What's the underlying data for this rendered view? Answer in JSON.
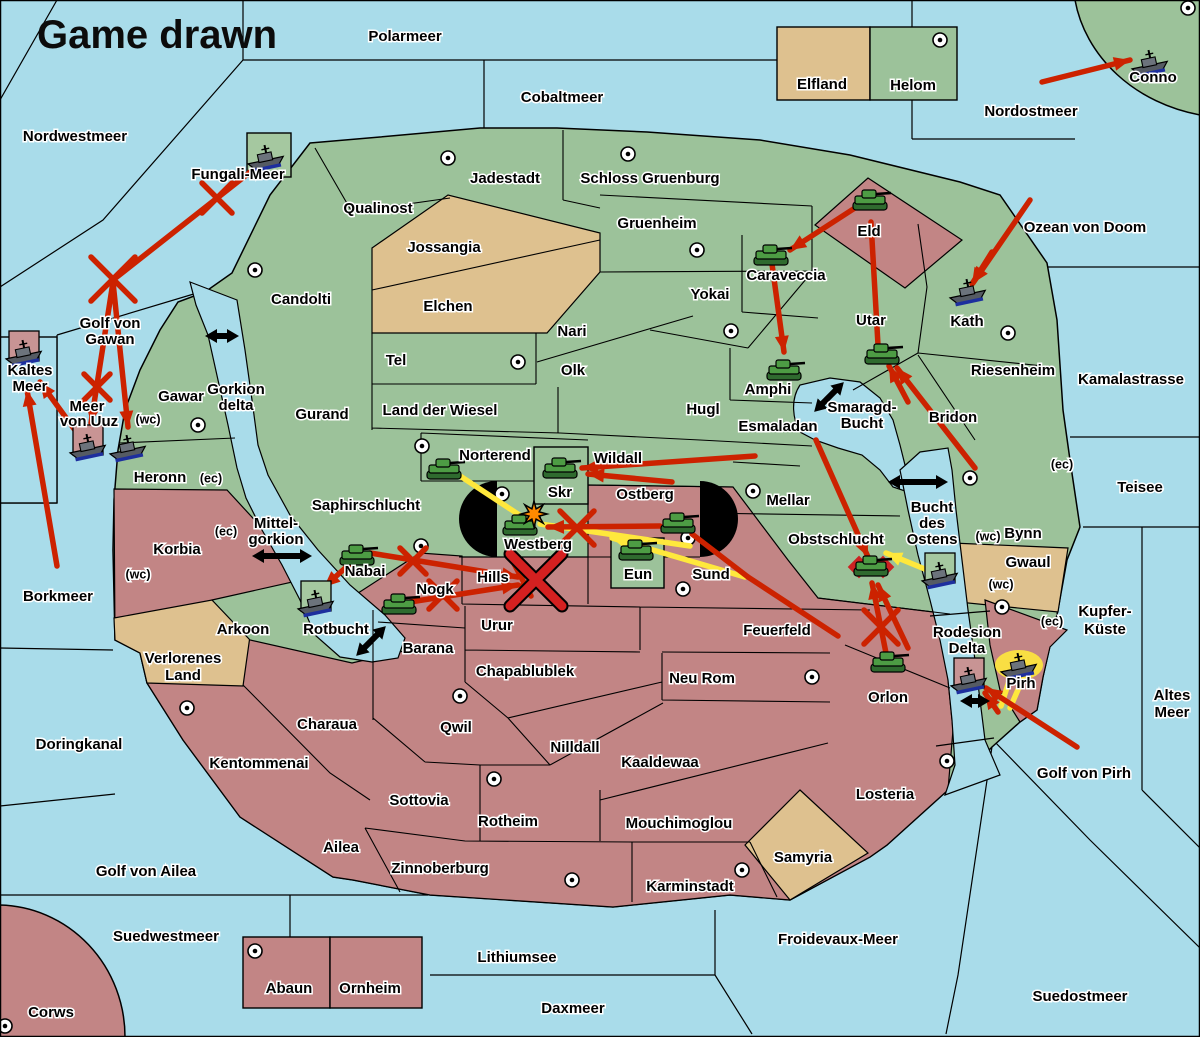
{
  "title": "Game drawn",
  "colors": {
    "sea": "#a9dcea",
    "land_green": "#9cc29a",
    "land_tan": "#dec18f",
    "land_red": "#c28585",
    "order_red": "#cc2200",
    "order_yellow": "#ffe83c",
    "unit_box_green": "#a5c8a0",
    "unit_box_pink": "#c89494",
    "gate_black": "#000000",
    "starburst_orange": "#ff8a00"
  },
  "labels": [
    {
      "t": "Polarmeer",
      "x": 405,
      "y": 37
    },
    {
      "t": "Nordwestmeer",
      "x": 75,
      "y": 137
    },
    {
      "t": "Cobaltmeer",
      "x": 562,
      "y": 98
    },
    {
      "t": "Nordostmeer",
      "x": 1031,
      "y": 112
    },
    {
      "t": "Fungali-Meer",
      "x": 238,
      "y": 175
    },
    {
      "t": "Golf von",
      "x": 110,
      "y": 324
    },
    {
      "t": "Gawan",
      "x": 110,
      "y": 340
    },
    {
      "t": "Kaltes",
      "x": 30,
      "y": 371
    },
    {
      "t": "Meer",
      "x": 30,
      "y": 387
    },
    {
      "t": "Meer",
      "x": 87,
      "y": 407
    },
    {
      "t": "von Uuz",
      "x": 89,
      "y": 422
    },
    {
      "t": "(wc)",
      "x": 148,
      "y": 420,
      "small": true
    },
    {
      "t": "Gorkion",
      "x": 236,
      "y": 390
    },
    {
      "t": "delta",
      "x": 236,
      "y": 406
    },
    {
      "t": "Gawar",
      "x": 181,
      "y": 397
    },
    {
      "t": "Heronn",
      "x": 160,
      "y": 478
    },
    {
      "t": "(ec)",
      "x": 211,
      "y": 479,
      "small": true
    },
    {
      "t": "Mittel-",
      "x": 276,
      "y": 524
    },
    {
      "t": "gorkion",
      "x": 276,
      "y": 540
    },
    {
      "t": "Korbia",
      "x": 177,
      "y": 550
    },
    {
      "t": "(ec)",
      "x": 226,
      "y": 532,
      "small": true
    },
    {
      "t": "(wc)",
      "x": 138,
      "y": 575,
      "small": true
    },
    {
      "t": "Borkmeer",
      "x": 58,
      "y": 597
    },
    {
      "t": "Saphirschlucht",
      "x": 366,
      "y": 506
    },
    {
      "t": "Doringkanal",
      "x": 79,
      "y": 745
    },
    {
      "t": "Golf von Ailea",
      "x": 146,
      "y": 872
    },
    {
      "t": "Suedwestmeer",
      "x": 166,
      "y": 937
    },
    {
      "t": "Corws",
      "x": 51,
      "y": 1013
    },
    {
      "t": "Abaun",
      "x": 289,
      "y": 989
    },
    {
      "t": "Ornheim",
      "x": 370,
      "y": 989
    },
    {
      "t": "Lithiumsee",
      "x": 517,
      "y": 958
    },
    {
      "t": "Daxmeer",
      "x": 573,
      "y": 1009
    },
    {
      "t": "Froidevaux-Meer",
      "x": 838,
      "y": 940
    },
    {
      "t": "Suedostmeer",
      "x": 1080,
      "y": 997
    },
    {
      "t": "Golf von Pirh",
      "x": 1084,
      "y": 774
    },
    {
      "t": "Altes",
      "x": 1172,
      "y": 696
    },
    {
      "t": "Meer",
      "x": 1172,
      "y": 713
    },
    {
      "t": "Kupfer-",
      "x": 1105,
      "y": 612
    },
    {
      "t": "Küste",
      "x": 1105,
      "y": 630
    },
    {
      "t": "Teisee",
      "x": 1140,
      "y": 488
    },
    {
      "t": "Kamalastrasse",
      "x": 1131,
      "y": 380
    },
    {
      "t": "Ozean von Doom",
      "x": 1085,
      "y": 228
    },
    {
      "t": "Jadestadt",
      "x": 505,
      "y": 179
    },
    {
      "t": "Schloss Gruenburg",
      "x": 650,
      "y": 179
    },
    {
      "t": "Qualinost",
      "x": 378,
      "y": 209
    },
    {
      "t": "Jossangia",
      "x": 444,
      "y": 248
    },
    {
      "t": "Elchen",
      "x": 448,
      "y": 307
    },
    {
      "t": "Candolti",
      "x": 301,
      "y": 300
    },
    {
      "t": "Gruenheim",
      "x": 657,
      "y": 224
    },
    {
      "t": "Yokai",
      "x": 710,
      "y": 295
    },
    {
      "t": "Nari",
      "x": 572,
      "y": 332
    },
    {
      "t": "Olk",
      "x": 573,
      "y": 371
    },
    {
      "t": "Tel",
      "x": 396,
      "y": 361
    },
    {
      "t": "Gurand",
      "x": 322,
      "y": 415
    },
    {
      "t": "Land der Wiesel",
      "x": 440,
      "y": 411
    },
    {
      "t": "Hugl",
      "x": 703,
      "y": 410
    },
    {
      "t": "Esmaladan",
      "x": 778,
      "y": 427
    },
    {
      "t": "Smaragd-",
      "x": 862,
      "y": 408
    },
    {
      "t": "Bucht",
      "x": 862,
      "y": 424
    },
    {
      "t": "Norterend",
      "x": 495,
      "y": 456
    },
    {
      "t": "Wildall",
      "x": 618,
      "y": 459
    },
    {
      "t": "Skr",
      "x": 560,
      "y": 493
    },
    {
      "t": "Ostberg",
      "x": 645,
      "y": 495
    },
    {
      "t": "Westberg",
      "x": 538,
      "y": 545
    },
    {
      "t": "Eun",
      "x": 638,
      "y": 575
    },
    {
      "t": "Sund",
      "x": 711,
      "y": 575
    },
    {
      "t": "Mellar",
      "x": 788,
      "y": 501
    },
    {
      "t": "Obstschlucht",
      "x": 836,
      "y": 540
    },
    {
      "t": "Hills",
      "x": 493,
      "y": 578
    },
    {
      "t": "Nogk",
      "x": 435,
      "y": 590
    },
    {
      "t": "Nabai",
      "x": 365,
      "y": 572
    },
    {
      "t": "Rotbucht",
      "x": 336,
      "y": 630
    },
    {
      "t": "Barana",
      "x": 428,
      "y": 649
    },
    {
      "t": "Urur",
      "x": 497,
      "y": 626
    },
    {
      "t": "Feuerfeld",
      "x": 777,
      "y": 631
    },
    {
      "t": "Chapablublek",
      "x": 525,
      "y": 672
    },
    {
      "t": "Neu Rom",
      "x": 702,
      "y": 679
    },
    {
      "t": "Qwil",
      "x": 456,
      "y": 728
    },
    {
      "t": "Nilldall",
      "x": 575,
      "y": 748
    },
    {
      "t": "Kaaldewaa",
      "x": 660,
      "y": 763
    },
    {
      "t": "Rotheim",
      "x": 508,
      "y": 822
    },
    {
      "t": "Mouchimoglou",
      "x": 679,
      "y": 824
    },
    {
      "t": "Sottovia",
      "x": 419,
      "y": 801
    },
    {
      "t": "Zinnoberburg",
      "x": 440,
      "y": 869
    },
    {
      "t": "Karminstadt",
      "x": 690,
      "y": 887
    },
    {
      "t": "Samyria",
      "x": 803,
      "y": 858
    },
    {
      "t": "Losteria",
      "x": 885,
      "y": 795
    },
    {
      "t": "Orlon",
      "x": 888,
      "y": 698
    },
    {
      "t": "Charaua",
      "x": 327,
      "y": 725
    },
    {
      "t": "Kentommenai",
      "x": 259,
      "y": 764
    },
    {
      "t": "Ailea",
      "x": 341,
      "y": 848
    },
    {
      "t": "Verlorenes",
      "x": 183,
      "y": 659
    },
    {
      "t": "Land",
      "x": 183,
      "y": 676
    },
    {
      "t": "Arkoon",
      "x": 243,
      "y": 630
    },
    {
      "t": "Eld",
      "x": 869,
      "y": 232
    },
    {
      "t": "Caraveccia",
      "x": 786,
      "y": 276
    },
    {
      "t": "Amphi",
      "x": 768,
      "y": 390
    },
    {
      "t": "Utar",
      "x": 871,
      "y": 321
    },
    {
      "t": "Kath",
      "x": 967,
      "y": 322
    },
    {
      "t": "Riesenheim",
      "x": 1013,
      "y": 371
    },
    {
      "t": "Bridon",
      "x": 953,
      "y": 418
    },
    {
      "t": "Bynn",
      "x": 1023,
      "y": 534
    },
    {
      "t": "Gwaul",
      "x": 1028,
      "y": 563
    },
    {
      "t": "(ec)",
      "x": 1062,
      "y": 465,
      "small": true
    },
    {
      "t": "(wc)",
      "x": 988,
      "y": 537,
      "small": true
    },
    {
      "t": "(wc)",
      "x": 1001,
      "y": 585,
      "small": true
    },
    {
      "t": "(ec)",
      "x": 1052,
      "y": 622,
      "small": true
    },
    {
      "t": "Bucht",
      "x": 932,
      "y": 508
    },
    {
      "t": "des",
      "x": 932,
      "y": 524
    },
    {
      "t": "Ostens",
      "x": 932,
      "y": 540
    },
    {
      "t": "Rodesion",
      "x": 967,
      "y": 633
    },
    {
      "t": "Delta",
      "x": 967,
      "y": 649
    },
    {
      "t": "Pirh",
      "x": 1021,
      "y": 684
    },
    {
      "t": "Elfland",
      "x": 822,
      "y": 85
    },
    {
      "t": "Helom",
      "x": 913,
      "y": 86
    },
    {
      "t": "Conno",
      "x": 1153,
      "y": 78
    }
  ],
  "supply_centers": [
    [
      448,
      158
    ],
    [
      628,
      154
    ],
    [
      940,
      40
    ],
    [
      1188,
      8
    ],
    [
      697,
      250
    ],
    [
      518,
      362
    ],
    [
      198,
      425
    ],
    [
      255,
      270
    ],
    [
      731,
      331
    ],
    [
      1008,
      333
    ],
    [
      753,
      491
    ],
    [
      502,
      494
    ],
    [
      688,
      538
    ],
    [
      683,
      589
    ],
    [
      421,
      546
    ],
    [
      970,
      478
    ],
    [
      1002,
      607
    ],
    [
      947,
      761
    ],
    [
      187,
      708
    ],
    [
      460,
      696
    ],
    [
      812,
      677
    ],
    [
      494,
      779
    ],
    [
      572,
      880
    ],
    [
      742,
      870
    ],
    [
      255,
      951
    ],
    [
      5,
      1026
    ],
    [
      422,
      446
    ]
  ],
  "units": [
    {
      "k": "fleet",
      "x": 266,
      "y": 157
    },
    {
      "k": "fleet",
      "x": 24,
      "y": 352,
      "box": "pink"
    },
    {
      "k": "fleet",
      "x": 88,
      "y": 446,
      "box": "pink"
    },
    {
      "k": "fleet",
      "x": 128,
      "y": 447
    },
    {
      "k": "fleet",
      "x": 316,
      "y": 602,
      "box": "green"
    },
    {
      "k": "fleet",
      "x": 940,
      "y": 574,
      "box": "green"
    },
    {
      "k": "fleet",
      "x": 969,
      "y": 679,
      "box": "pink"
    },
    {
      "k": "fleet",
      "x": 1019,
      "y": 665,
      "glow": true
    },
    {
      "k": "fleet",
      "x": 1150,
      "y": 62
    },
    {
      "k": "fleet",
      "x": 968,
      "y": 291
    },
    {
      "k": "army",
      "x": 870,
      "y": 201
    },
    {
      "k": "army",
      "x": 771,
      "y": 256
    },
    {
      "k": "army",
      "x": 784,
      "y": 371
    },
    {
      "k": "army",
      "x": 882,
      "y": 355
    },
    {
      "k": "army",
      "x": 444,
      "y": 470
    },
    {
      "k": "army",
      "x": 560,
      "y": 469
    },
    {
      "k": "army",
      "x": 520,
      "y": 526
    },
    {
      "k": "army",
      "x": 636,
      "y": 551
    },
    {
      "k": "army",
      "x": 678,
      "y": 524
    },
    {
      "k": "army",
      "x": 399,
      "y": 605
    },
    {
      "k": "army",
      "x": 357,
      "y": 556
    },
    {
      "k": "army",
      "x": 871,
      "y": 567,
      "dislodged": true
    },
    {
      "k": "army",
      "x": 888,
      "y": 663
    }
  ],
  "arrows": [
    {
      "c": "red",
      "x1": 1042,
      "y1": 82,
      "x2": 1130,
      "y2": 60,
      "head": true
    },
    {
      "c": "red",
      "x1": 1030,
      "y1": 200,
      "x2": 973,
      "y2": 283,
      "head": true
    },
    {
      "c": "red",
      "x1": 992,
      "y1": 252,
      "x2": 972,
      "y2": 284,
      "head": true
    },
    {
      "c": "red",
      "x1": 858,
      "y1": 206,
      "x2": 790,
      "y2": 250,
      "head": true
    },
    {
      "c": "red",
      "x1": 772,
      "y1": 264,
      "x2": 784,
      "y2": 352,
      "head": true
    },
    {
      "c": "red",
      "x1": 878,
      "y1": 345,
      "x2": 871,
      "y2": 222,
      "head": true
    },
    {
      "c": "red",
      "x1": 975,
      "y1": 468,
      "x2": 897,
      "y2": 368,
      "head": true
    },
    {
      "c": "red",
      "x1": 908,
      "y1": 402,
      "x2": 889,
      "y2": 366,
      "head": true
    },
    {
      "c": "red",
      "x1": 755,
      "y1": 456,
      "x2": 582,
      "y2": 468,
      "head": true
    },
    {
      "c": "red",
      "x1": 672,
      "y1": 482,
      "x2": 588,
      "y2": 474,
      "head": true
    },
    {
      "c": "red",
      "x1": 660,
      "y1": 526,
      "x2": 548,
      "y2": 527,
      "head": true
    },
    {
      "c": "red",
      "x1": 692,
      "y1": 534,
      "x2": 748,
      "y2": 577,
      "head": false
    },
    {
      "c": "red",
      "x1": 748,
      "y1": 577,
      "x2": 838,
      "y2": 636,
      "head": false
    },
    {
      "c": "red",
      "x1": 816,
      "y1": 440,
      "x2": 868,
      "y2": 557,
      "head": true
    },
    {
      "c": "red",
      "x1": 886,
      "y1": 653,
      "x2": 872,
      "y2": 583,
      "head": true
    },
    {
      "c": "red",
      "x1": 908,
      "y1": 648,
      "x2": 878,
      "y2": 585,
      "head": true
    },
    {
      "c": "red",
      "x1": 1077,
      "y1": 747,
      "x2": 986,
      "y2": 688,
      "head": true
    },
    {
      "c": "red",
      "x1": 998,
      "y1": 712,
      "x2": 985,
      "y2": 693,
      "head": true
    },
    {
      "c": "red",
      "x1": 370,
      "y1": 553,
      "x2": 518,
      "y2": 577,
      "head": true
    },
    {
      "c": "red",
      "x1": 410,
      "y1": 602,
      "x2": 518,
      "y2": 585,
      "head": true
    },
    {
      "c": "red",
      "x1": 510,
      "y1": 556,
      "x2": 531,
      "y2": 596,
      "head": true
    },
    {
      "c": "red",
      "x1": 352,
      "y1": 562,
      "x2": 324,
      "y2": 587,
      "head": true
    },
    {
      "c": "red",
      "x1": 263,
      "y1": 162,
      "x2": 113,
      "y2": 280,
      "head": false
    },
    {
      "c": "red",
      "x1": 113,
      "y1": 282,
      "x2": 91,
      "y2": 423,
      "head": true
    },
    {
      "c": "red",
      "x1": 113,
      "y1": 282,
      "x2": 128,
      "y2": 427,
      "head": true
    },
    {
      "c": "red",
      "x1": 80,
      "y1": 437,
      "x2": 40,
      "y2": 382,
      "head": true
    },
    {
      "c": "red",
      "x1": 57,
      "y1": 566,
      "x2": 27,
      "y2": 390,
      "head": true
    },
    {
      "c": "yellow",
      "x1": 448,
      "y1": 468,
      "x2": 530,
      "y2": 522,
      "head": false
    },
    {
      "c": "yellow",
      "x1": 745,
      "y1": 577,
      "x2": 612,
      "y2": 538,
      "head": true
    },
    {
      "c": "yellow",
      "x1": 690,
      "y1": 546,
      "x2": 540,
      "y2": 524,
      "head": false
    },
    {
      "c": "yellow",
      "x1": 932,
      "y1": 572,
      "x2": 886,
      "y2": 553,
      "head": true
    },
    {
      "c": "yellow",
      "x1": 1012,
      "y1": 672,
      "x2": 1001,
      "y2": 706,
      "head": false
    },
    {
      "c": "yellow",
      "x1": 1024,
      "y1": 676,
      "x2": 1010,
      "y2": 708,
      "head": false
    }
  ],
  "x_marks": [
    {
      "x": 217,
      "y": 198,
      "s": 15
    },
    {
      "x": 113,
      "y": 279,
      "s": 22
    },
    {
      "x": 97,
      "y": 387,
      "s": 13
    },
    {
      "x": 577,
      "y": 528,
      "s": 17
    },
    {
      "x": 413,
      "y": 561,
      "s": 13
    },
    {
      "x": 443,
      "y": 595,
      "s": 14
    },
    {
      "x": 536,
      "y": 580,
      "s": 26,
      "big": true
    },
    {
      "x": 881,
      "y": 627,
      "s": 17
    }
  ],
  "two_way_arrows": [
    {
      "x": 222,
      "y": 336,
      "l": 34,
      "a": 0
    },
    {
      "x": 282,
      "y": 556,
      "l": 60,
      "a": 0
    },
    {
      "x": 918,
      "y": 482,
      "l": 60,
      "a": 0
    },
    {
      "x": 975,
      "y": 701,
      "l": 30,
      "a": 0
    },
    {
      "x": 829,
      "y": 397,
      "l": 42,
      "a": -45
    },
    {
      "x": 371,
      "y": 641,
      "l": 42,
      "a": -45
    }
  ],
  "starbursts": [
    {
      "x": 534,
      "y": 514
    }
  ],
  "gates": [
    {
      "x": 497,
      "y": 519,
      "r": 38,
      "open": "left"
    },
    {
      "x": 700,
      "y": 519,
      "r": 38,
      "open": "right"
    }
  ],
  "boxes": [
    {
      "x": 777,
      "y": 27,
      "w": 93,
      "h": 73,
      "f": "tan"
    },
    {
      "x": 870,
      "y": 27,
      "w": 87,
      "h": 73,
      "f": "green"
    },
    {
      "x": 243,
      "y": 937,
      "w": 87,
      "h": 71,
      "f": "red"
    },
    {
      "x": 330,
      "y": 937,
      "w": 92,
      "h": 71,
      "f": "red"
    },
    {
      "x": 0,
      "y": 337,
      "w": 57,
      "h": 166,
      "f": "sea"
    },
    {
      "x": 247,
      "y": 133,
      "w": 44,
      "h": 44,
      "f": "greenbox"
    },
    {
      "x": 534,
      "y": 447,
      "w": 54,
      "h": 57,
      "f": "green"
    },
    {
      "x": 611,
      "y": 538,
      "w": 53,
      "h": 50,
      "f": "green"
    }
  ]
}
